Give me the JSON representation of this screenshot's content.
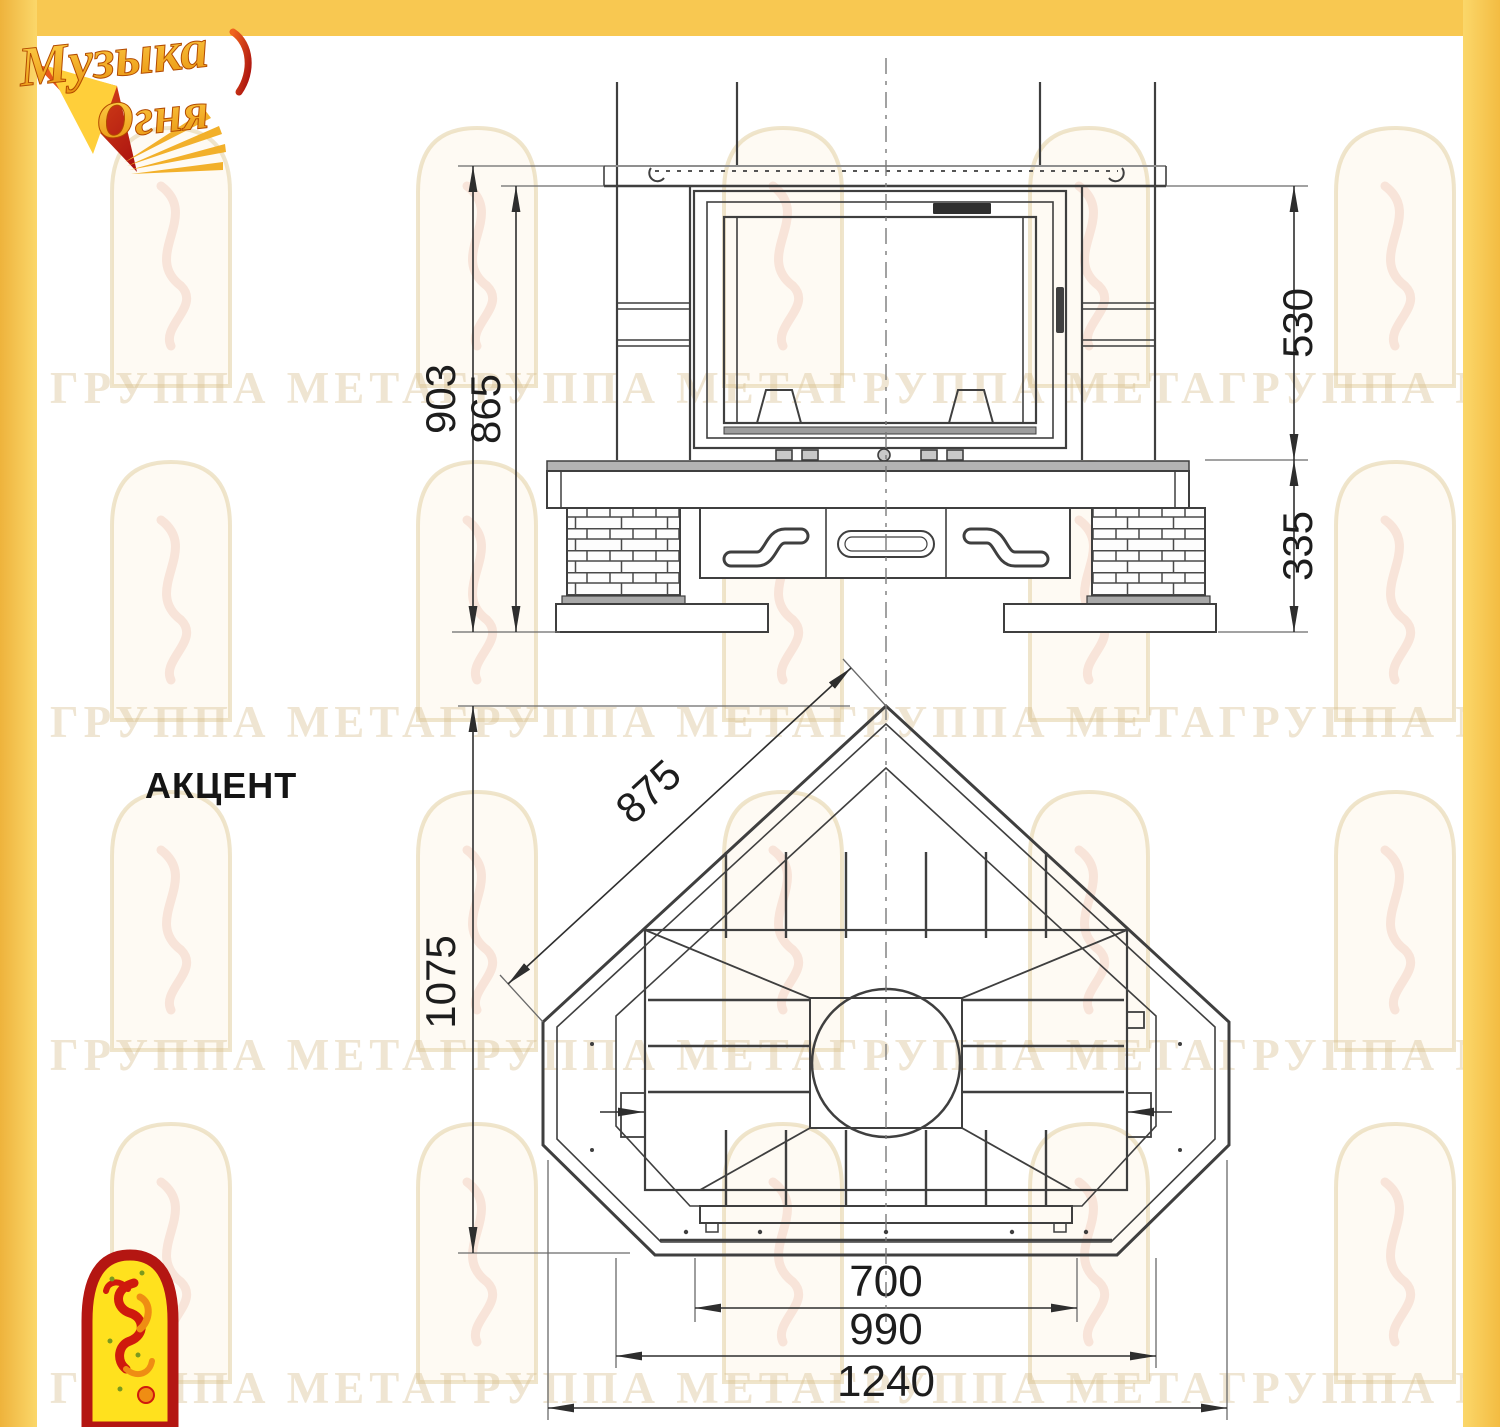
{
  "model": {
    "name": "АКЦЕНТ"
  },
  "logo_top": {
    "word1": "Музыка",
    "word2": "Огня"
  },
  "watermark": {
    "row_text": "ГРУППА МЕТАГРУППА МЕТАГРУППА МЕТАГРУППА МЕТА"
  },
  "front_view": {
    "dims": {
      "total_height": "903",
      "body_height": "865",
      "firebox_height": "530",
      "base_height": "335"
    }
  },
  "plan_view": {
    "dims": {
      "side_depth": "875",
      "total_depth": "1075",
      "firebox_width": "700",
      "body_width": "990",
      "total_width": "1240"
    }
  },
  "colors": {
    "frame_yellow": "#f8c851",
    "drawing_line": "#3f3f3f",
    "watermark_tone": "#d6be8e",
    "logo_gold": "#f2a31c",
    "logo_red": "#c21807"
  }
}
